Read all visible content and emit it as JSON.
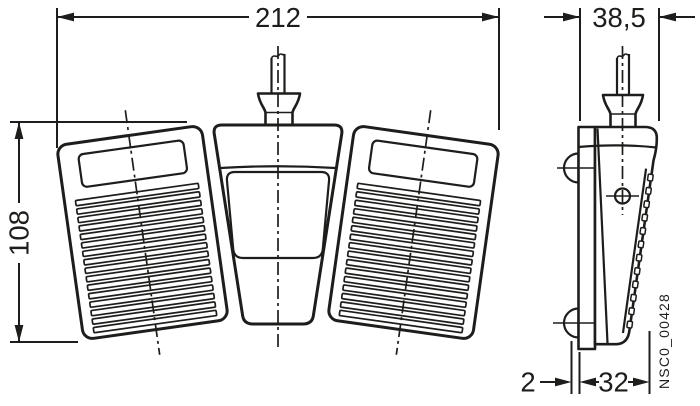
{
  "figure": {
    "line_color": "#1d1d1b",
    "background": "#ffffff"
  },
  "dimensions": {
    "overall_width": "212",
    "overall_height": "108",
    "side_width": "38,5",
    "base_gap": "2",
    "base_depth": "32"
  },
  "doc_number": "NSC0_00428"
}
